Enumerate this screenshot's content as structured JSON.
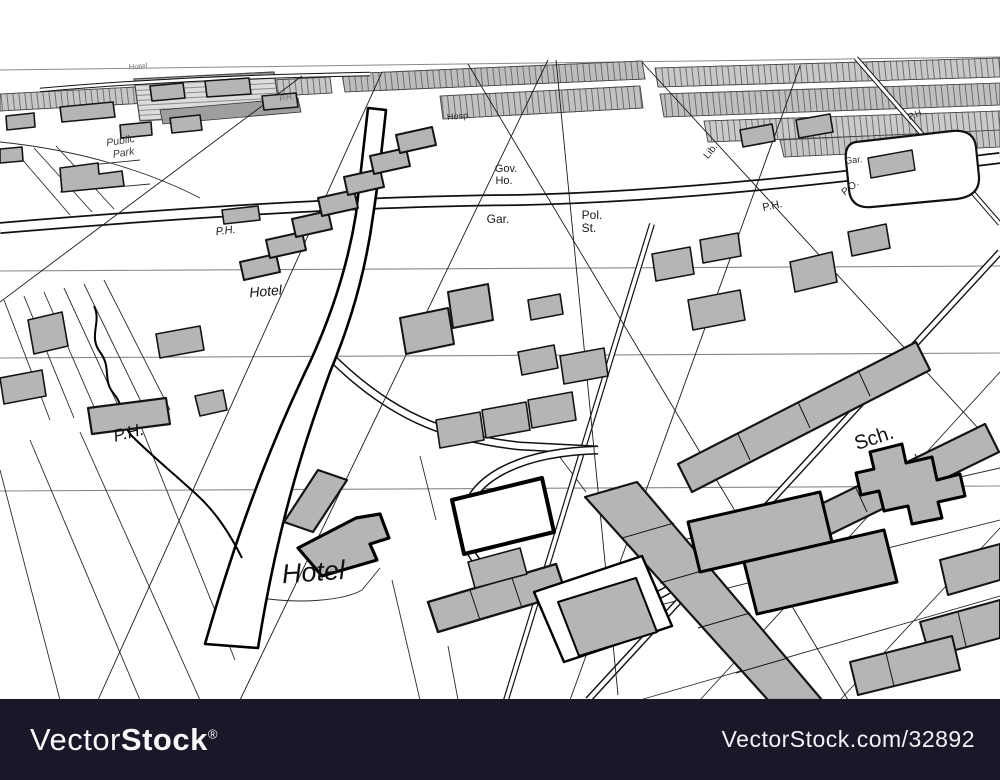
{
  "page": {
    "background": "#ffffff"
  },
  "colors": {
    "bar": "#181828",
    "building": "#b5b5b5",
    "ink": "#000000",
    "paper": "#ffffff"
  },
  "map": {
    "description": "Perspective street map illustration",
    "labels": [
      {
        "text": "Hotel",
        "x": 138,
        "y": 69,
        "size": 8,
        "italic": true,
        "rotate": -4,
        "color": "#787878"
      },
      {
        "text": "P.H.",
        "x": 287,
        "y": 100,
        "size": 8,
        "italic": true,
        "rotate": -10,
        "color": "#6e6e6e"
      },
      {
        "text": "Public",
        "x": 121,
        "y": 144,
        "size": 10.5,
        "italic": true,
        "rotate": -9,
        "color": "#3a3a3a"
      },
      {
        "text": "Park",
        "x": 124,
        "y": 156,
        "size": 10.5,
        "italic": true,
        "rotate": -9,
        "color": "#3a3a3a"
      },
      {
        "text": "Hosp.",
        "x": 459,
        "y": 119,
        "size": 9,
        "italic": false,
        "rotate": -5,
        "color": "#2a2a2a"
      },
      {
        "text": "Gov.",
        "x": 506,
        "y": 172,
        "size": 11,
        "italic": false,
        "rotate": 0,
        "color": "#1a1a1a"
      },
      {
        "text": "Ho.",
        "x": 504,
        "y": 184,
        "size": 11,
        "italic": false,
        "rotate": 0,
        "color": "#1a1a1a"
      },
      {
        "text": "Gar.",
        "x": 498,
        "y": 223,
        "size": 12,
        "italic": false,
        "rotate": 0,
        "color": "#1a1a1a"
      },
      {
        "text": "Pol.",
        "x": 592,
        "y": 219,
        "size": 12,
        "italic": false,
        "rotate": 0,
        "color": "#1a1a1a"
      },
      {
        "text": "St.",
        "x": 589,
        "y": 232,
        "size": 12,
        "italic": false,
        "rotate": 0,
        "color": "#1a1a1a"
      },
      {
        "text": "Lib.",
        "x": 713,
        "y": 153,
        "size": 10,
        "italic": false,
        "rotate": -52,
        "color": "#2a2a2a"
      },
      {
        "text": "P.H.",
        "x": 917,
        "y": 117,
        "size": 9,
        "italic": false,
        "rotate": -22,
        "color": "#2a2a2a"
      },
      {
        "text": "Gar.",
        "x": 854,
        "y": 163,
        "size": 9,
        "italic": false,
        "rotate": -6,
        "color": "#2a2a2a"
      },
      {
        "text": "P.O.",
        "x": 852,
        "y": 190,
        "size": 10,
        "italic": false,
        "rotate": -38,
        "color": "#2a2a2a"
      },
      {
        "text": "P.H.",
        "x": 773,
        "y": 209,
        "size": 11,
        "italic": false,
        "rotate": -12,
        "color": "#1a1a1a"
      },
      {
        "text": "P.H.",
        "x": 226,
        "y": 234,
        "size": 11,
        "italic": true,
        "rotate": -7,
        "color": "#1a1a1a"
      },
      {
        "text": "Hotel",
        "x": 266,
        "y": 296,
        "size": 14,
        "italic": true,
        "rotate": -5,
        "color": "#111111"
      },
      {
        "text": "P.H.",
        "x": 130,
        "y": 438,
        "size": 17,
        "italic": true,
        "rotate": -14,
        "color": "#111111"
      },
      {
        "text": "Sch.",
        "x": 876,
        "y": 444,
        "size": 20,
        "italic": false,
        "rotate": -18,
        "color": "#111111"
      },
      {
        "text": "Hotel",
        "x": 314,
        "y": 581,
        "size": 27,
        "italic": true,
        "rotate": -4,
        "color": "#111111"
      }
    ]
  },
  "watermark": {
    "bar_color": "#181828",
    "brand_light": "Vector",
    "brand_bold": "Stock",
    "registered": "®",
    "site_text": "VectorStock.com/32892"
  }
}
